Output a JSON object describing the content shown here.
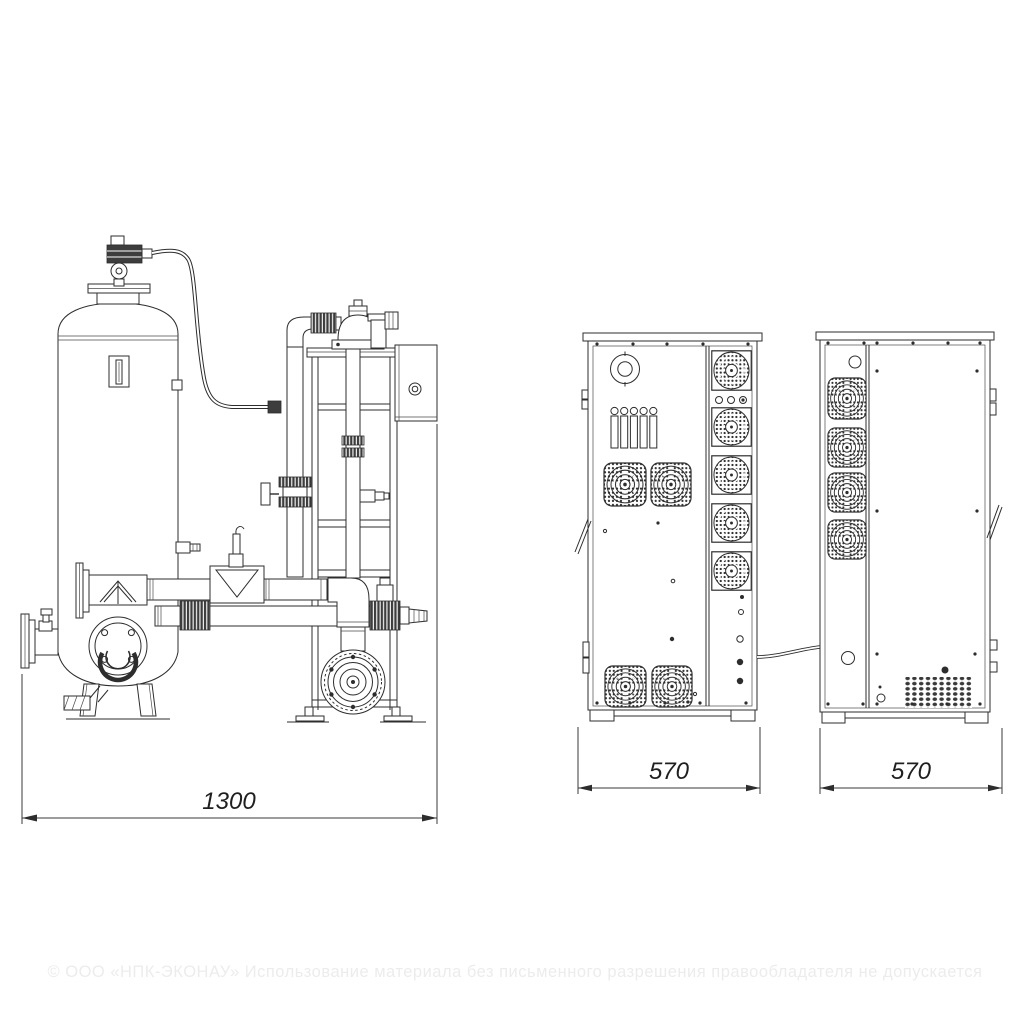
{
  "drawing": {
    "dimensions": {
      "skid_width": "1300",
      "cabinet_rear_width": "570",
      "cabinet_side_width": "570"
    },
    "watermark": "© ООО «НПК-ЭКОНАУ» Использование материала без письменного разрешения правообладателя не допускается",
    "colors": {
      "line": "#2d2d2d",
      "background": "#ffffff",
      "watermark": "#ececec"
    }
  }
}
